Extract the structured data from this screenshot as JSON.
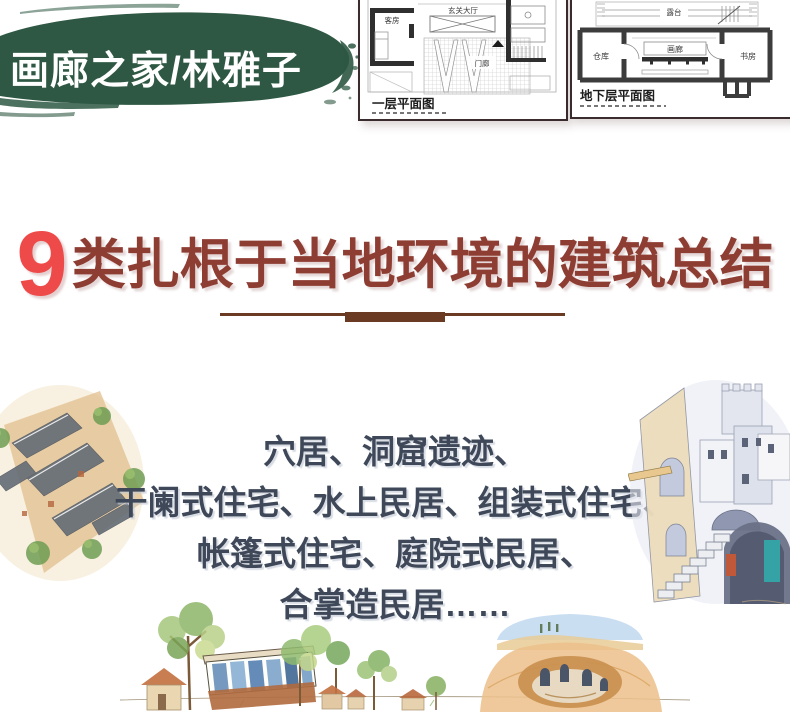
{
  "banner": {
    "title": "画廊之家/林雅子",
    "bg_color": "#2e5843",
    "text_color": "#ffffff"
  },
  "floor_plans": [
    {
      "caption": "一层平面图",
      "rooms": [
        "客房",
        "玄关大厅",
        "门廊"
      ]
    },
    {
      "caption": "地下层平面图",
      "rooms": [
        "露台",
        "仓库",
        "画廊",
        "书房"
      ]
    }
  ],
  "headline": {
    "number": "9",
    "text": "类扎根于当地环境的建筑总结",
    "number_color": "#ee4a4a",
    "text_color": "#8e3d33"
  },
  "divider_color": "#6b3a23",
  "body": {
    "lines": [
      "穴居、洞窟遗迹、",
      "干阑式住宅、水上民居、组装式住宅、",
      "帐篷式住宅、庭院式民居、",
      "合掌造民居……"
    ],
    "text_color": "#3e4858"
  },
  "illustrations": {
    "left": "courtyard-house-watercolor",
    "right": "stone-village-watercolor",
    "bottom": "village-and-pit-dwelling-watercolor"
  }
}
